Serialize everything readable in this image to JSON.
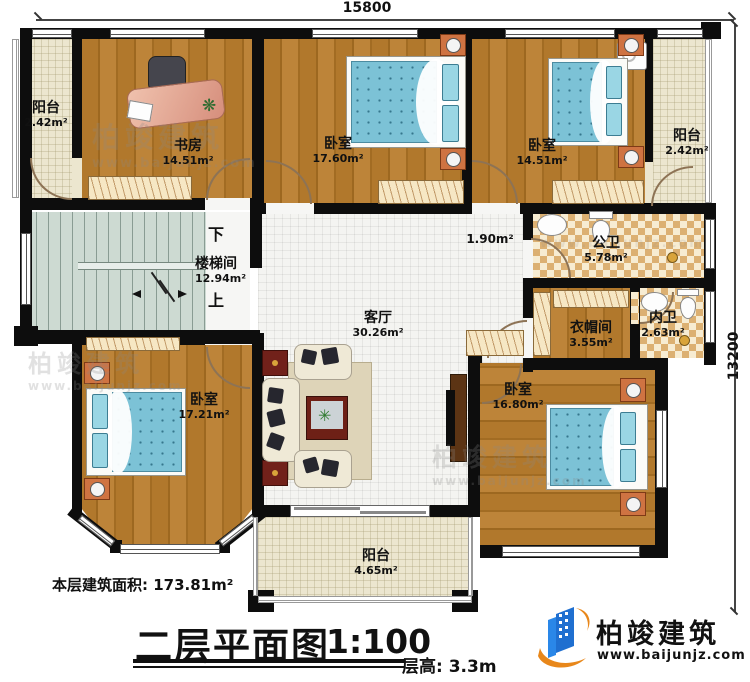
{
  "dims": {
    "top": "15800",
    "right": "13200"
  },
  "rooms": {
    "balcony_nw": {
      "name": "阳台",
      "area": "2.42m²"
    },
    "study": {
      "name": "书房",
      "area": "14.51m²"
    },
    "bedroom_n": {
      "name": "卧室",
      "area": "17.60m²"
    },
    "bedroom_ne": {
      "name": "卧室",
      "area": "14.51m²"
    },
    "balcony_ne": {
      "name": "阳台",
      "area": "2.42m²"
    },
    "stairwell": {
      "name": "楼梯间",
      "area": "12.94m²"
    },
    "bath_public": {
      "name": "公卫",
      "area": "5.78m²"
    },
    "cloakroom": {
      "name": "衣帽间",
      "area": "3.55m²"
    },
    "bath_private": {
      "name": "内卫",
      "area": "2.63m²"
    },
    "living": {
      "name": "客厅",
      "area": "30.26m²"
    },
    "bedroom_sw": {
      "name": "卧室",
      "area": "17.21m²"
    },
    "bedroom_se": {
      "name": "卧室",
      "area": "16.80m²"
    },
    "balcony_s": {
      "name": "阳台",
      "area": "4.65m²"
    }
  },
  "hall": {
    "area": "1.90m²"
  },
  "stairs": {
    "down": "下",
    "up": "上"
  },
  "footer": {
    "floor_area": "本层建筑面积: 173.81m²",
    "plan_title": "二层平面图",
    "plan_scale": "1:100",
    "floor_height": "层高: 3.3m"
  },
  "brand": {
    "name": "柏竣建筑",
    "url": "www.baijunjz.com"
  },
  "watermark": {
    "name": "柏竣建筑",
    "url": "www.baijunjz.com"
  }
}
